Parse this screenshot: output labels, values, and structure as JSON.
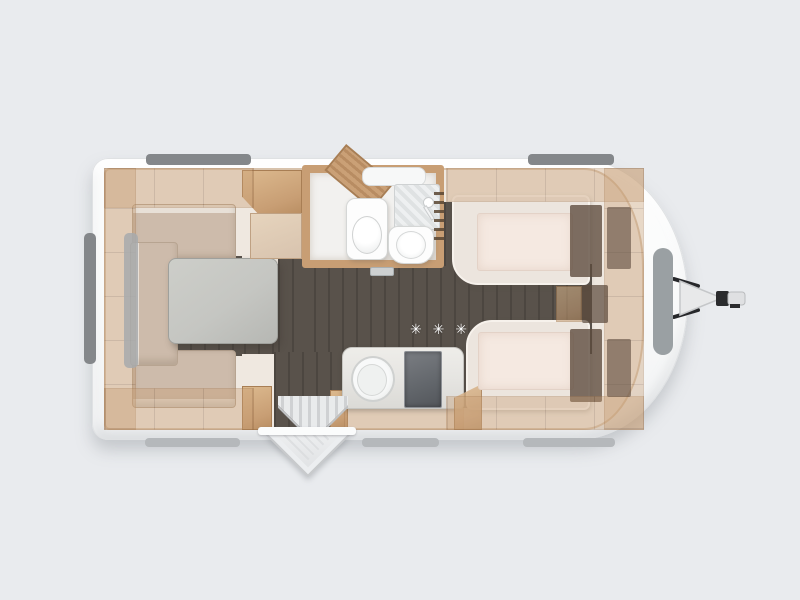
{
  "scene": {
    "type": "caravan-floorplan-render",
    "view": "top-down",
    "title": "Caravan interior floor plan",
    "labels": {
      "hob_stars": "✳ ✳ ✳"
    },
    "colors": {
      "background": "#e9ebee",
      "shell": "#fafbfb",
      "shell_edge": "#dfe1e3",
      "interior": "#efe8e0",
      "floor": "#59524b",
      "wood": "#c89e74",
      "wood_dark": "#a87e54",
      "cushion": "#cdbbab",
      "cushion_light": "#e8e0d7",
      "table": "#c5c6c2",
      "bed_base": "#ece5de",
      "mattress": "#f5e9e1",
      "headboard": "#5c4a3c",
      "fixture": "#fdfdfd",
      "counter": "#e6e5e2",
      "cooktop": "#62666b",
      "window_dark": "#84878a",
      "window_mid": "#9aa0a3",
      "window_light": "#b5b8bb",
      "hitch_body": "#e8e9ea",
      "hitch_metal": "#26272a",
      "stars": "#ffffff"
    },
    "rooms": {
      "dinette": [
        "u-shaped-seating",
        "table",
        "overhead-lockers",
        "wardrobe"
      ],
      "washroom": [
        "corner-shelf",
        "washbasin",
        "toilet",
        "shower",
        "towel-rail"
      ],
      "kitchen": [
        "round-sink",
        "hob",
        "hob-rating-stars"
      ],
      "bedroom": [
        "single-bed-top",
        "single-bed-bottom",
        "wardrobes",
        "bedside-unit"
      ]
    },
    "exterior": [
      "tow-hitch",
      "entry-door-open",
      "top-windows",
      "rear-window",
      "front-window",
      "bottom-windows"
    ]
  }
}
